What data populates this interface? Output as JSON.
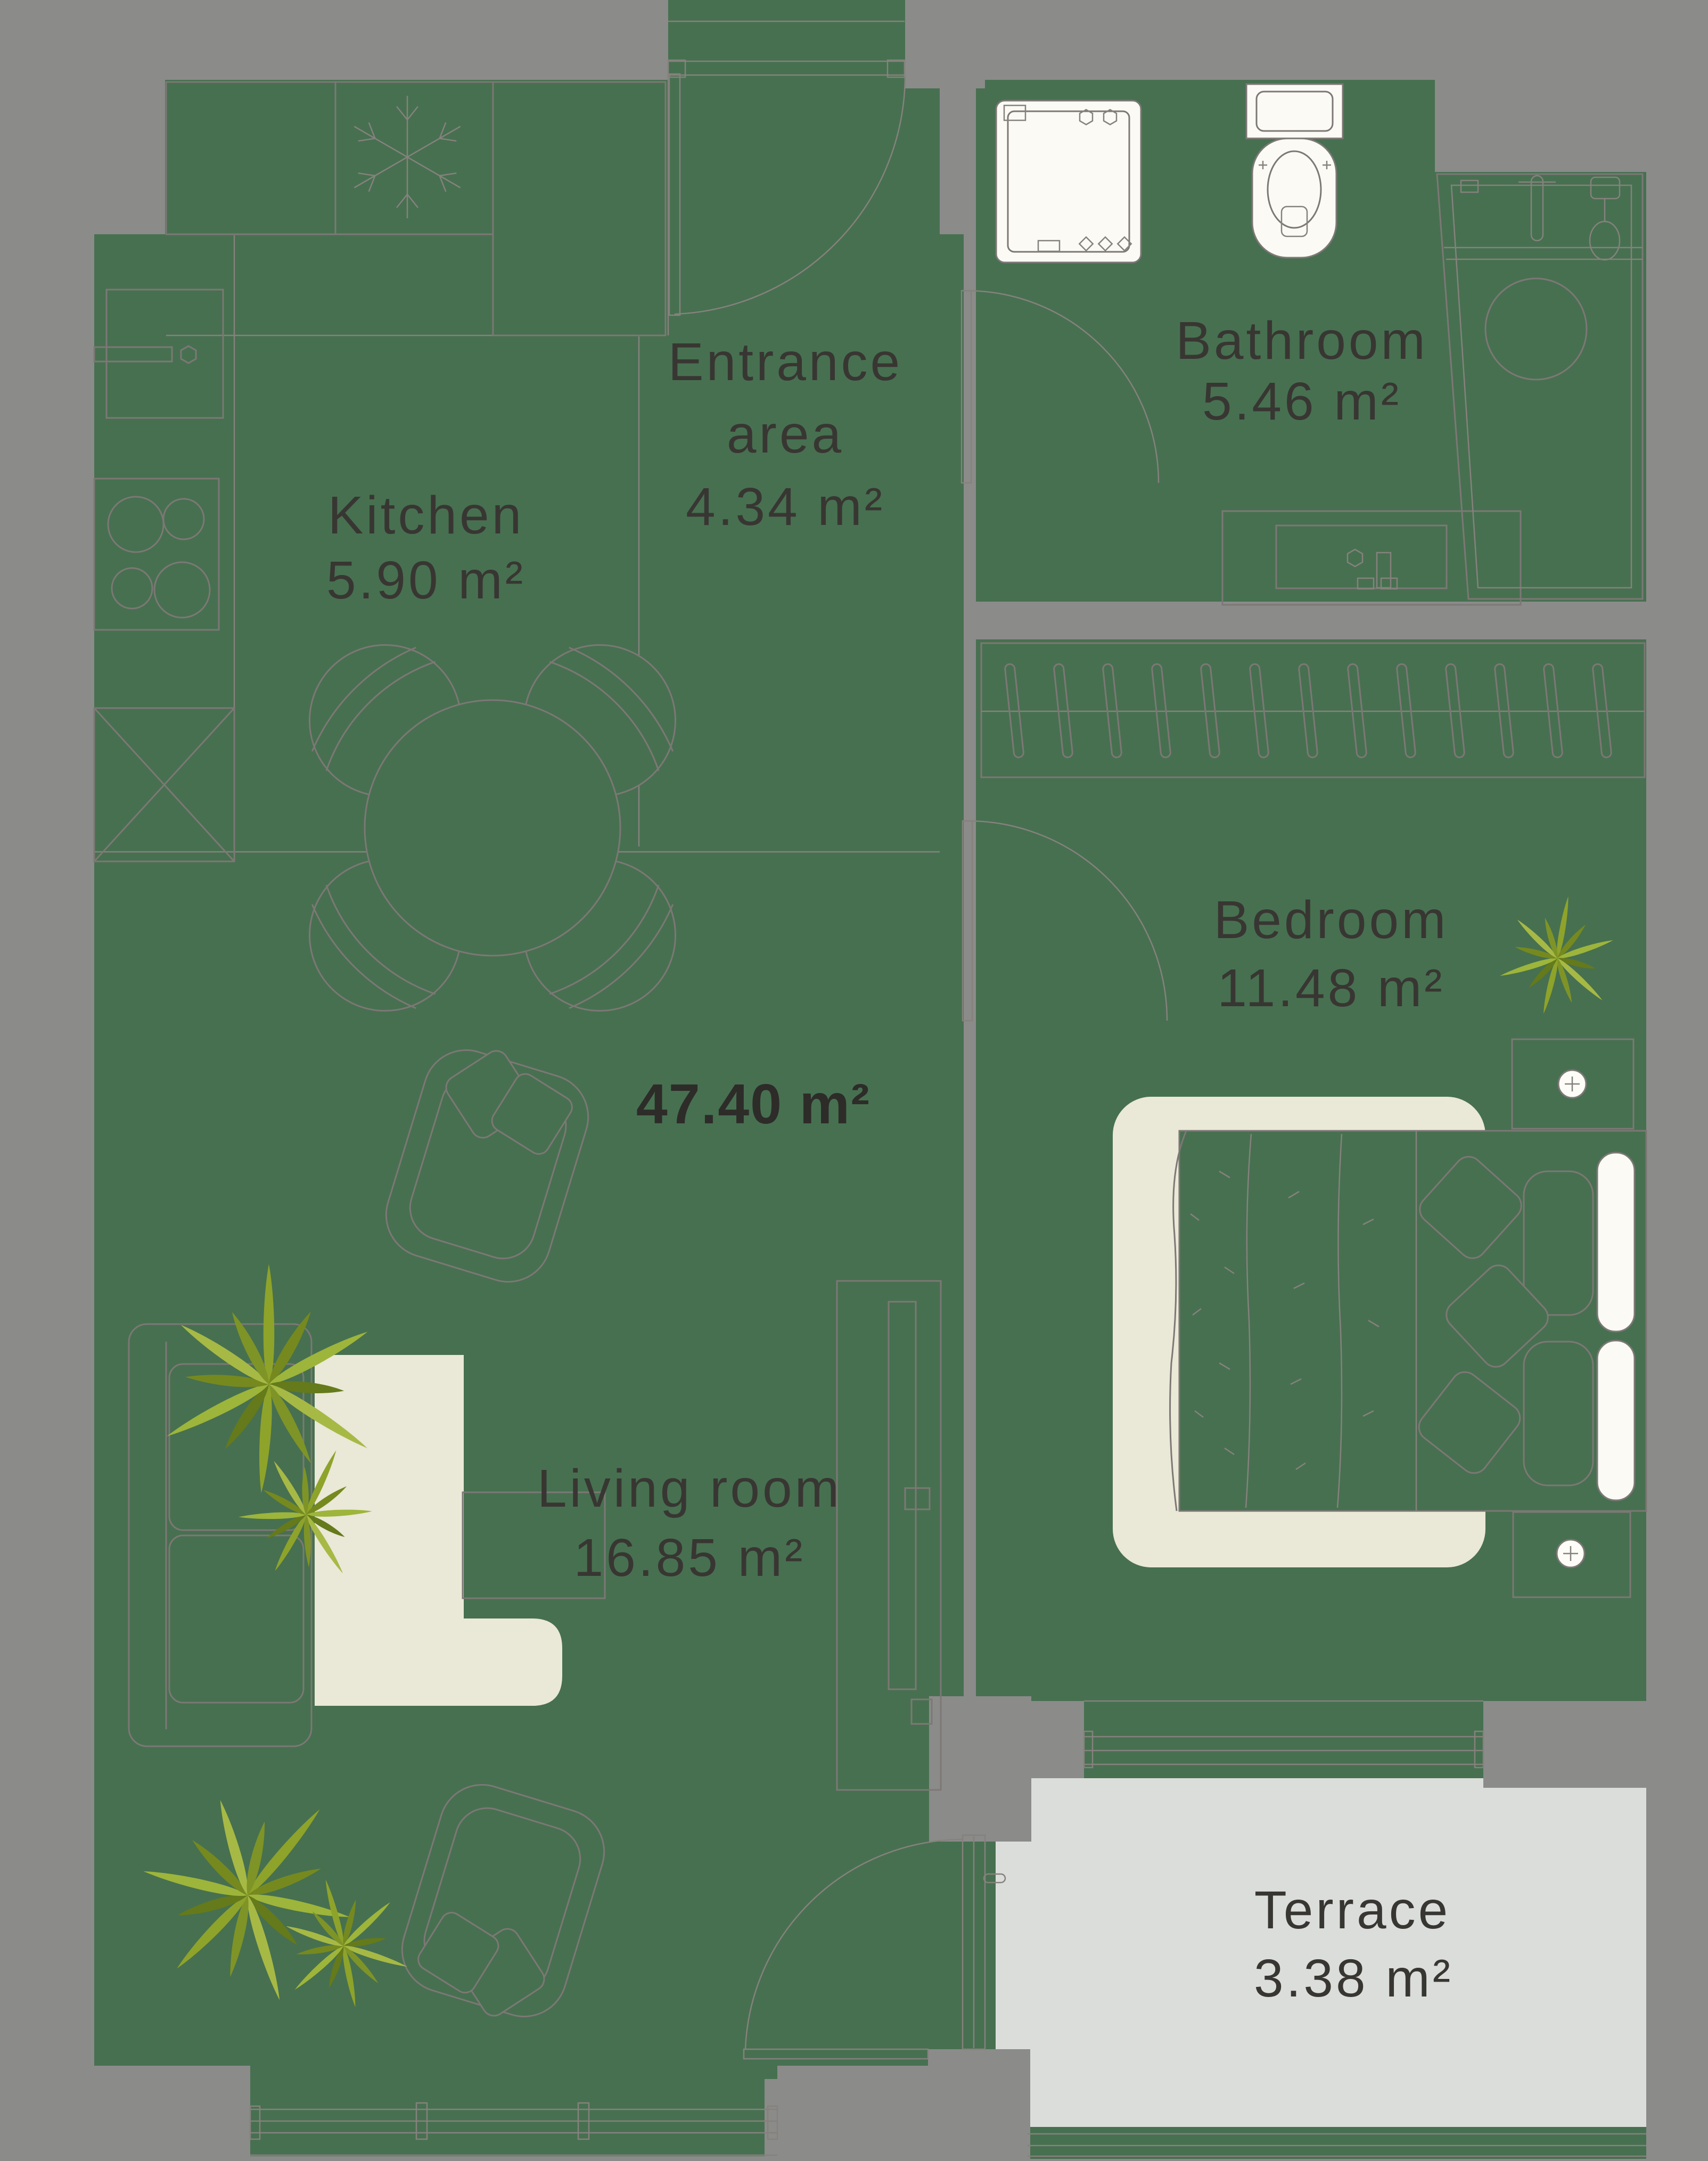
{
  "plan": {
    "type": "apartment-floor-plan",
    "colors": {
      "background": "#8b8b8a",
      "floor": "#477050",
      "terrace_floor": "#dbddda",
      "rug": "#eae8d7",
      "fixture_white": "#fbfaf5",
      "outline": "#7c7875",
      "text": "#383632",
      "plant_green": "#8ea32a"
    },
    "total": {
      "area_label": "47.40 m²"
    },
    "rooms": {
      "kitchen": {
        "name": "Kitchen",
        "area": "5.90 m²"
      },
      "entrance": {
        "line1": "Entrance",
        "line2": "area",
        "area": "4.34 m²"
      },
      "bathroom": {
        "name": "Bathroom",
        "area": "5.46 m²"
      },
      "bedroom": {
        "name": "Bedroom",
        "area": "11.48 m²"
      },
      "living_room": {
        "name": "Living room",
        "area": "16.85 m²"
      },
      "terrace": {
        "name": "Terrace",
        "area": "3.38 m²"
      }
    }
  }
}
